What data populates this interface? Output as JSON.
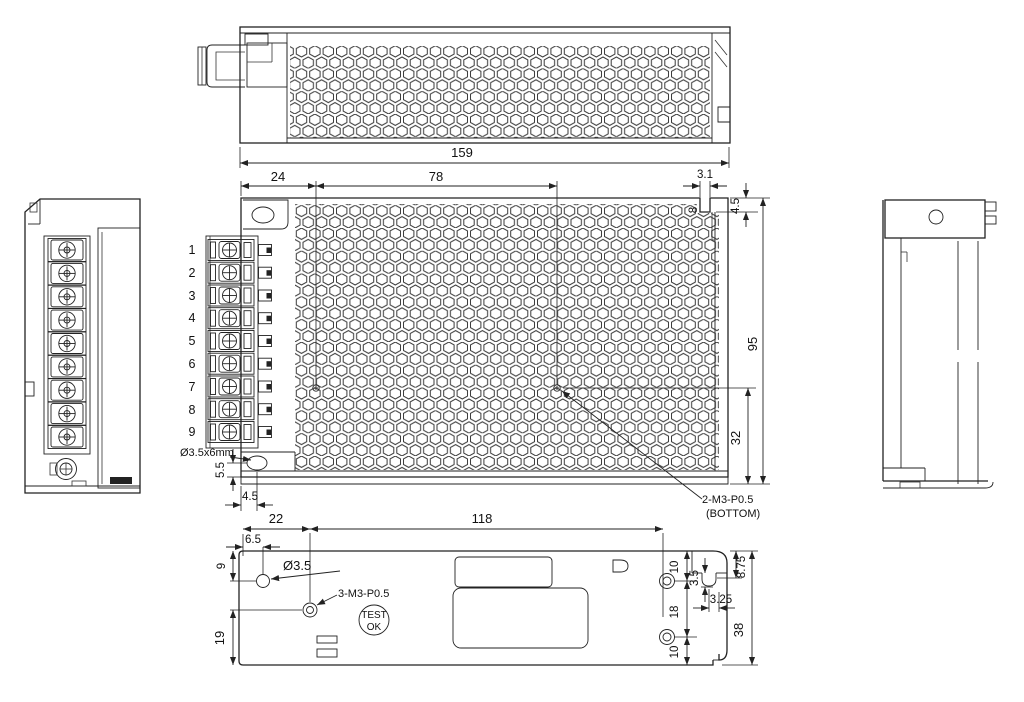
{
  "views": {
    "top": {
      "d159": "159"
    },
    "front": {
      "d24": "24",
      "d78": "78",
      "d31": "3.1",
      "d45t": "4.5",
      "d8": "8",
      "d95": "95",
      "d32": "32",
      "d55": "5.5",
      "d45b": "4.5",
      "slot_label": "Ø3.5x6mm",
      "note1": "2-M3-P0.5",
      "note2": "(BOTTOM)",
      "terminals": [
        "1",
        "2",
        "3",
        "4",
        "5",
        "6",
        "7",
        "8",
        "9"
      ]
    },
    "bottom": {
      "d22": "22",
      "d118": "118",
      "d65": "6.5",
      "d9": "9",
      "d19": "19",
      "hole_label": "Ø3.5",
      "screw_note": "3-M3-P0.5",
      "btn1": "TEST",
      "btn2": "OK",
      "d10a": "10",
      "d18": "18",
      "d10b": "10",
      "d35": "3.5",
      "d325": "3.25",
      "d875": "8.75",
      "d38": "38"
    }
  },
  "colors": {
    "line": "#222222",
    "background": "#ffffff"
  }
}
